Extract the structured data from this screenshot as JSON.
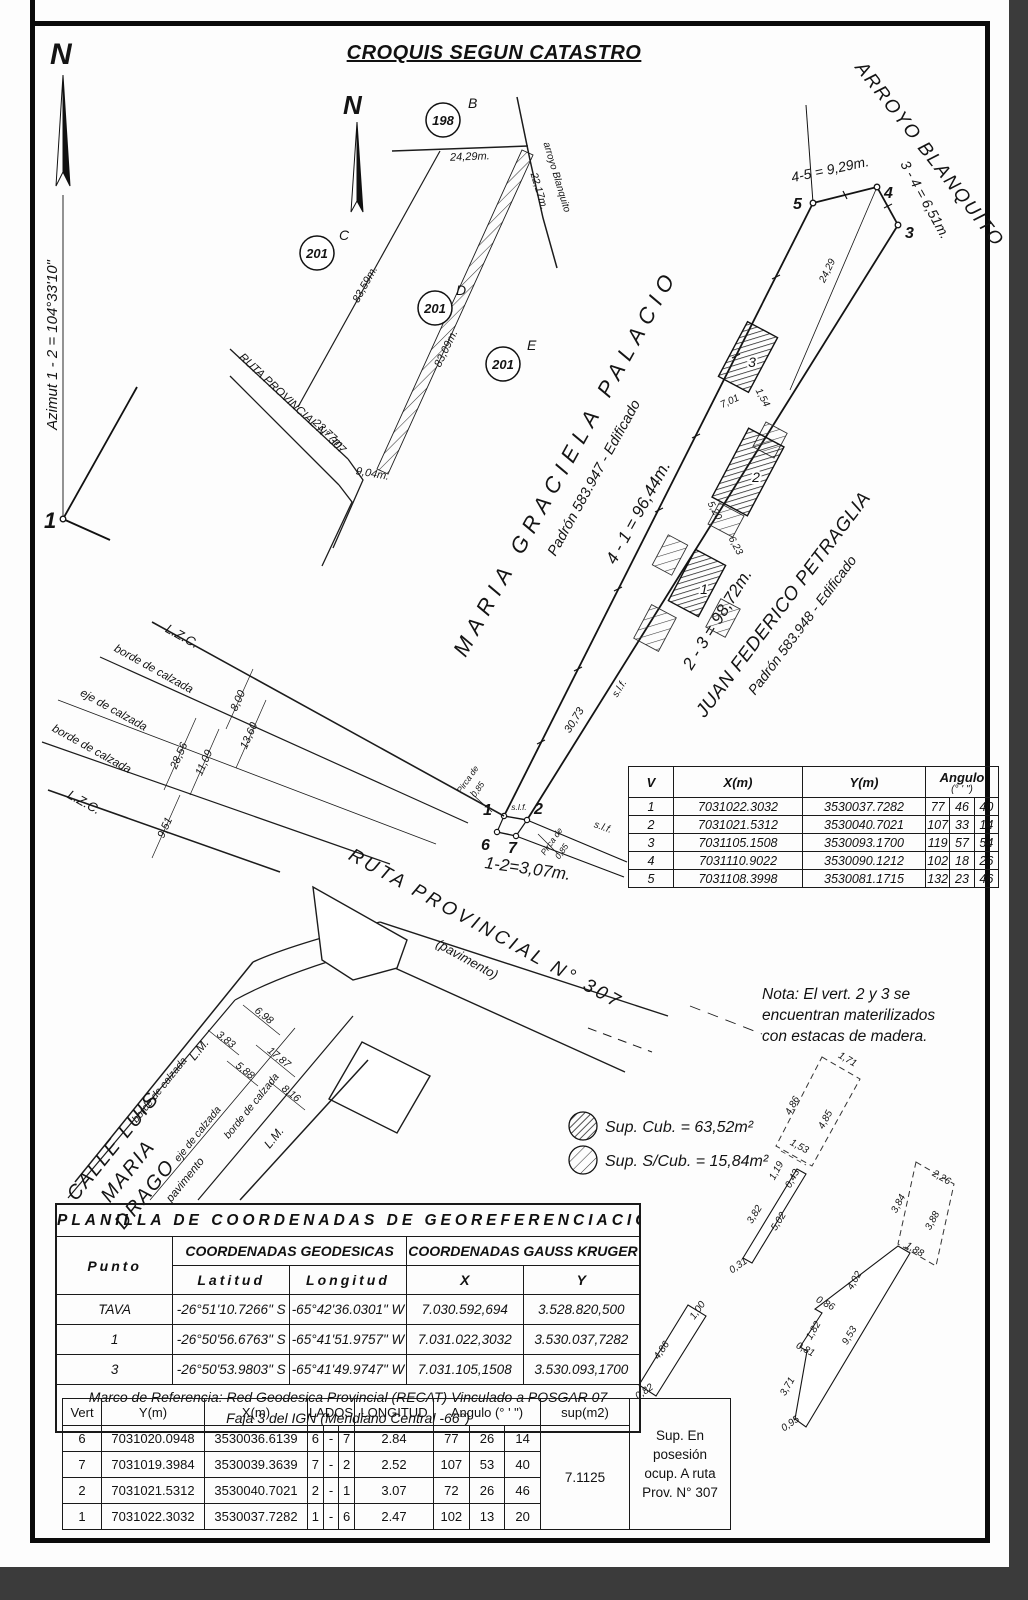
{
  "title": "CROQUIS SEGUN CATASTRO",
  "compass": {
    "n1": "N",
    "n2": "N"
  },
  "azimut": "Azimut 1 - 2 = 104°33'10\"",
  "big_vertex_1": "1",
  "upper_sketch": {
    "parcel_198": "198",
    "letter_b": "B",
    "parcel_201": "201",
    "letter_c": "C",
    "letter_d": "D",
    "letter_e": "E",
    "dim_24_29": "24,29m.",
    "arroyo": "arroyo Blanquito",
    "dim_22_17": "22,17m.",
    "dim_83_59": "83,59m.",
    "dim_83_09": "83,09m.",
    "road": "RUTA PROVINCIAL N° 307",
    "dim_23_77": "23,77m.",
    "dim_9_04": "9,04m."
  },
  "parcel": {
    "arroyo": "ARROYO BLANQUITO",
    "side_4_5": "4-5 = 9,29m.",
    "side_3_4": "3 - 4 = 6,51m.",
    "side_4_1": "4 - 1 = 96,44m.",
    "side_2_3": "2 - 3 = 98,72m.",
    "side_1_2": "1-2=3,07m.",
    "dim_24_29": "24,29",
    "dim_30_73": "30,73",
    "slf": "s.l.f.",
    "v1": "1",
    "v2": "2",
    "v3": "3",
    "v4": "4",
    "v5": "5",
    "v6": "6",
    "v7": "7",
    "b1": "1",
    "b2": "2",
    "b3": "3",
    "dim_7_01": "7,01",
    "dim_1_54": "1,54",
    "dim_5_20": "5,20",
    "dim_6_23": "6,23",
    "pirca_l1": "Pirca de",
    "pirca_l2": "0,85",
    "owner_nw": {
      "name": "MARIA GRACIELA PALACIO",
      "padron": "Padrón 583.947 - Edificado"
    },
    "owner_se": {
      "name": "JUAN FEDERICO PETRAGLIA",
      "padron": "Padrón 583.948 - Edificado"
    }
  },
  "streets": {
    "lzc": "L.Z.C.",
    "lzc2": "L.Z.C.",
    "borde": "borde de calzada",
    "eje": "eje de calzada",
    "borde2": "borde de calzada",
    "dim_8_00": "8,00",
    "dim_13_60": "13,60",
    "dim_28_56": "28,56",
    "dim_11_09": "11,09",
    "dim_9_51": "9,51",
    "ruta": "RUTA PROVINCIAL N° 307",
    "pavimento": "(pavimento)",
    "calle_l1": "CALLE LUIS",
    "calle_l2": "MARIA",
    "calle_l3": "DRAGO",
    "lm": "L.M.",
    "lm2": "L.M.",
    "borde_c1": "borde de calzada",
    "eje_c": "eje de calzada",
    "borde_c2": "borde de calzada",
    "pav": "pavimento",
    "dim_6_98": "6,98",
    "dim_3_83": "3,83",
    "dim_17_87": "17,87",
    "dim_5_88": "5,88",
    "dim_8_16": "8,16"
  },
  "v_table": {
    "h_v": "V",
    "h_x": "X(m)",
    "h_y": "Y(m)",
    "h_ang": "Angulo",
    "h_ang_sub": "(° ' \")",
    "rows": [
      {
        "v": "1",
        "x": "7031022.3032",
        "y": "3530037.7282",
        "g": "77",
        "m": "46",
        "s": "40"
      },
      {
        "v": "2",
        "x": "7031021.5312",
        "y": "3530040.7021",
        "g": "107",
        "m": "33",
        "s": "14"
      },
      {
        "v": "3",
        "x": "7031105.1508",
        "y": "3530093.1700",
        "g": "119",
        "m": "57",
        "s": "54"
      },
      {
        "v": "4",
        "x": "7031110.9022",
        "y": "3530090.1212",
        "g": "102",
        "m": "18",
        "s": "26"
      },
      {
        "v": "5",
        "x": "7031108.3998",
        "y": "3530081.1715",
        "g": "132",
        "m": "23",
        "s": "46"
      }
    ]
  },
  "nota": {
    "l1": "Nota: El vert. 2 y 3 se",
    "l2": "encuentran materilizados",
    "l3": "con estacas de madera."
  },
  "legend": {
    "cub": "Sup. Cub. = 63,52m²",
    "scub": "Sup. S/Cub. = 15,84m²"
  },
  "detail_a": {
    "d171": "1,71",
    "d486": "4,86",
    "d485": "4,85",
    "d153": "1,53",
    "d119": "1,19",
    "d043": "0,43",
    "d382": "3,82",
    "d502": "5,02",
    "d031": "0,31"
  },
  "detail_b": {
    "d226": "2,26",
    "d384": "3,84",
    "d388": "3,88",
    "d188": "1,88",
    "d402": "4,02",
    "d086": "0,86",
    "d182": "1,82",
    "d081": "0,81",
    "d953": "9,53",
    "d371": "3,71",
    "d095": "0,95"
  },
  "detail_c": {
    "d100": "1,00",
    "d486": "4,86",
    "d082": "0,82"
  },
  "planilla": {
    "title": "PLANILLA DE COORDENADAS DE GEOREFERENCIACION",
    "h_punto": "Punto",
    "h_geo": "COORDENADAS GEODESICAS",
    "h_gk": "COORDENADAS GAUSS KRUGER",
    "h_lat": "Latitud",
    "h_lon": "Longitud",
    "h_x": "X",
    "h_y": "Y",
    "rows": [
      {
        "p": "TAVA",
        "lat": "-26°51'10.7266\" S",
        "lon": "-65°42'36.0301\" W",
        "x": "7.030.592,694",
        "y": "3.528.820,500"
      },
      {
        "p": "1",
        "lat": "-26°50'56.6763\" S",
        "lon": "-65°41'51.9757\" W",
        "x": "7.031.022,3032",
        "y": "3.530.037,7282"
      },
      {
        "p": "3",
        "lat": "-26°50'53.9803\" S",
        "lon": "-65°41'49.9747\" W",
        "x": "7.031.105,1508",
        "y": "3.530.093,1700"
      }
    ],
    "footer1": "Marco de Referencia: Red Geodesica Provincial (RECAT) Vinculado a POSGAR 07",
    "footer2": "Faja 3 del IGN  (Meridiano Central -66°)"
  },
  "bottom_table": {
    "h_vert": "Vert",
    "h_y": "Y(m)",
    "h_x": "X(m)",
    "h_lados": "LADOS",
    "h_long": "LONGITUD",
    "h_ang": "Angulo  (° ' \")",
    "h_sup": "sup(m2)",
    "rows": [
      {
        "v": "6",
        "y": "7031020.0948",
        "x": "3530036.6139",
        "la": "6",
        "ld": "-",
        "lb": "7",
        "lon": "2.84",
        "g": "77",
        "m": "26",
        "s": "14"
      },
      {
        "v": "7",
        "y": "7031019.3984",
        "x": "3530039.3639",
        "la": "7",
        "ld": "-",
        "lb": "2",
        "lon": "2.52",
        "g": "107",
        "m": "53",
        "s": "40"
      },
      {
        "v": "2",
        "y": "7031021.5312",
        "x": "3530040.7021",
        "la": "2",
        "ld": "-",
        "lb": "1",
        "lon": "3.07",
        "g": "72",
        "m": "26",
        "s": "46"
      },
      {
        "v": "1",
        "y": "7031022.3032",
        "x": "3530037.7282",
        "la": "1",
        "ld": "-",
        "lb": "6",
        "lon": "2.47",
        "g": "102",
        "m": "13",
        "s": "20"
      }
    ],
    "sup": "7.1125",
    "side": {
      "l1": "Sup. En",
      "l2": "posesión",
      "l3": "ocup. A ruta",
      "l4": "Prov. N° 307"
    }
  }
}
